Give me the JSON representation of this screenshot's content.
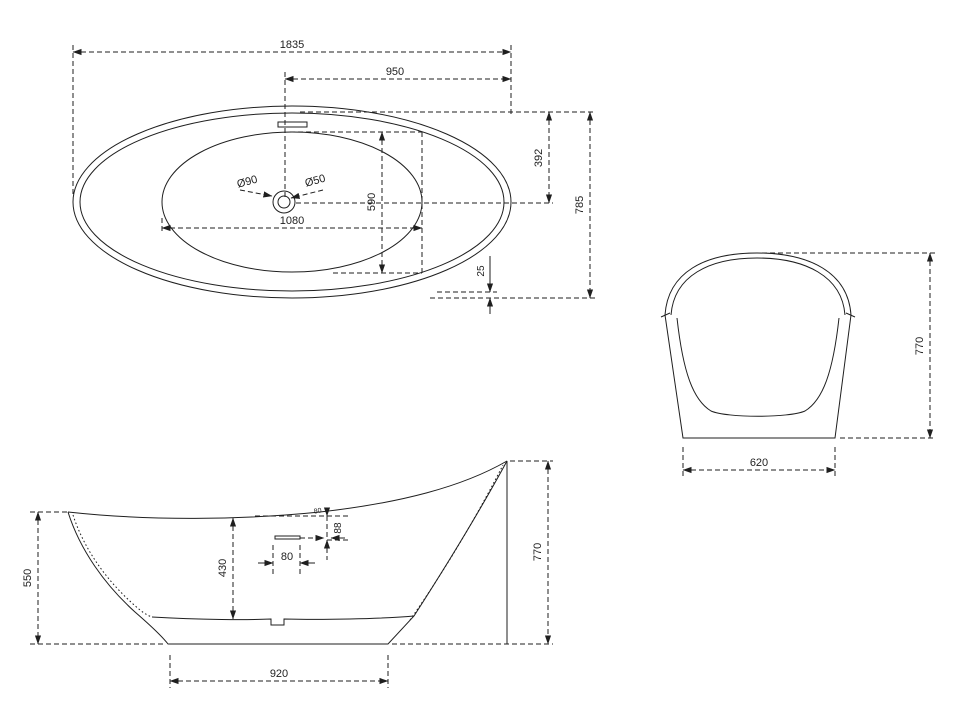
{
  "page": {
    "background": "#ffffff",
    "line_color": "#1f1f1f",
    "text_color": "#1f1f1f"
  },
  "top_view": {
    "overall_length": "1835",
    "drain_to_end": "950",
    "overall_width": "785",
    "center_to_edge": "392",
    "inner_length": "1080",
    "inner_width": "590",
    "bottom_rim_offset": "25",
    "drain_diameter": "Ø90",
    "waste_diameter": "Ø50"
  },
  "side_view": {
    "rim_height_low": "550",
    "rim_height_high": "770",
    "inner_depth": "430",
    "overflow_width": "80",
    "overflow_below_rim": "88",
    "overflow_note": "80",
    "base_length": "920"
  },
  "end_view": {
    "overall_height": "770",
    "base_width": "620"
  }
}
